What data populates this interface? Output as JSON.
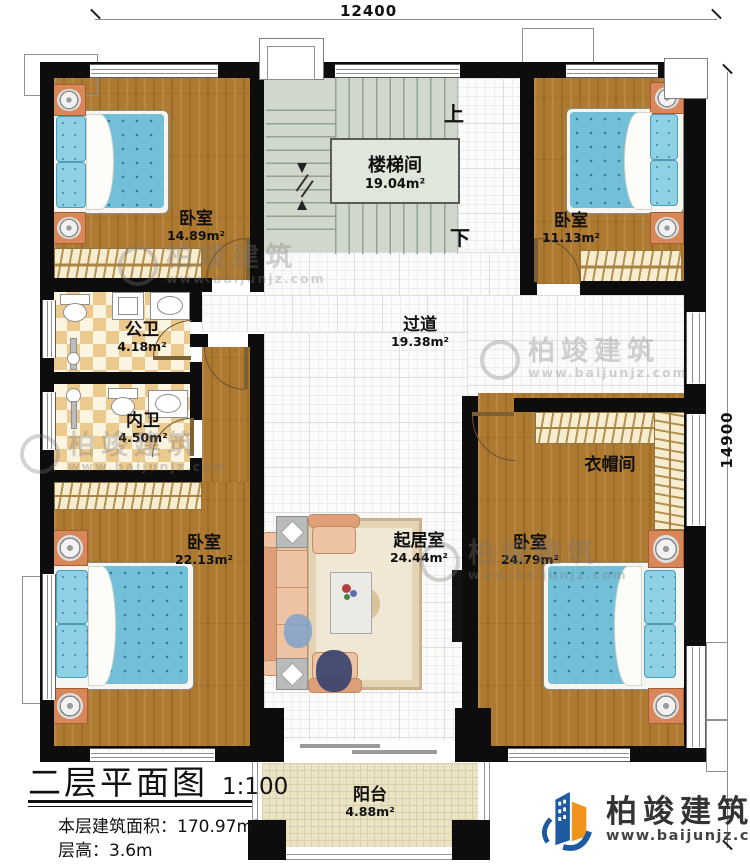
{
  "dimensions": {
    "top": "12400",
    "right": "14900"
  },
  "rooms": [
    {
      "name": "卧室",
      "area": "14.89m²"
    },
    {
      "name": "楼梯间",
      "area": "19.04m²"
    },
    {
      "name": "卧室",
      "area": "11.13m²"
    },
    {
      "name": "公卫",
      "area": "4.18m²"
    },
    {
      "name": "内卫",
      "area": "4.50m²"
    },
    {
      "name": "过道",
      "area": "19.38m²"
    },
    {
      "name": "衣帽间",
      "area": ""
    },
    {
      "name": "卧室",
      "area": "22.13m²"
    },
    {
      "name": "起居室",
      "area": "24.44m²"
    },
    {
      "name": "卧室",
      "area": "24.79m²"
    },
    {
      "name": "阳台",
      "area": "4.88m²"
    }
  ],
  "stairs": {
    "up": "上",
    "down": "下"
  },
  "title_block": {
    "title": "二层平面图",
    "scale": "1:100",
    "area_label": "本层建筑面积：",
    "area_value": "170.97m²",
    "height_label": "层高：",
    "height_value": "3.6m"
  },
  "brand": {
    "name": "柏竣建筑",
    "url": "www.baijunjz.com"
  },
  "colors": {
    "wall": "#0d0d0d",
    "wood_floor": "#ae7930",
    "tile_floor": "#fbfbfa",
    "stair_floor": "#cfd8ca",
    "bathroom_tile": "#ecca8e",
    "balcony_floor": "#ebe3c6",
    "bed_blue": "#73bfd7",
    "nightstand_orange": "#d8875a",
    "brand_blue": "#1e5aa0",
    "brand_orange": "#f0941e"
  }
}
